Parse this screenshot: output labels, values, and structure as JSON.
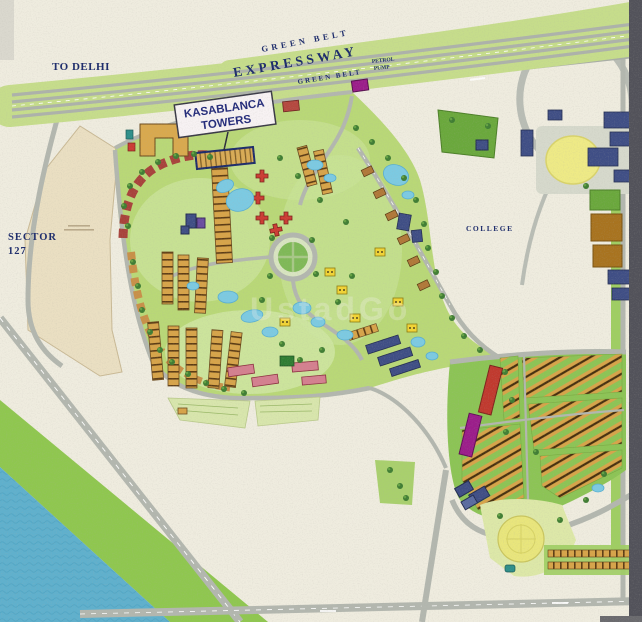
{
  "map": {
    "title": "Kasablanca Towers site plan map",
    "labels": {
      "to_delhi": "TO DELHI",
      "green_belt_upper": "GREEN BELT",
      "expressway": "EXPRESSWAY",
      "green_belt_lower": "GREEN BELT",
      "petrol_line1": "PETROL",
      "petrol_line2": "PUMP",
      "kasablanca_line1": "KASABLANCA",
      "kasablanca_line2": "TOWERS",
      "sector_line1": "SECTOR",
      "sector_line2": "127",
      "college": "COLLEGE",
      "watermark": "UstadGo"
    },
    "colors": {
      "paper": "#efecdf",
      "expressway_green": "#c6dd8b",
      "road_gray": "#b3b7af",
      "water_blue": "#5fb0cd",
      "river_green_belt": "#8fc74f",
      "lawn_green": "#b9d877",
      "sector_lawn": "#8cc455",
      "pond_blue": "#7ccae2",
      "house_tan": "#d7a449",
      "building_red": "#c0392e",
      "building_maroon": "#a8423b",
      "building_navy": "#3f4e85",
      "building_magenta": "#9b1d8a",
      "plot_brown": "#a8731f",
      "ground_yellow": "#e9e67c",
      "parcel_beige": "#eadfc2",
      "label_navy": "#1c2b6b",
      "border_dark": "#52525a"
    }
  }
}
